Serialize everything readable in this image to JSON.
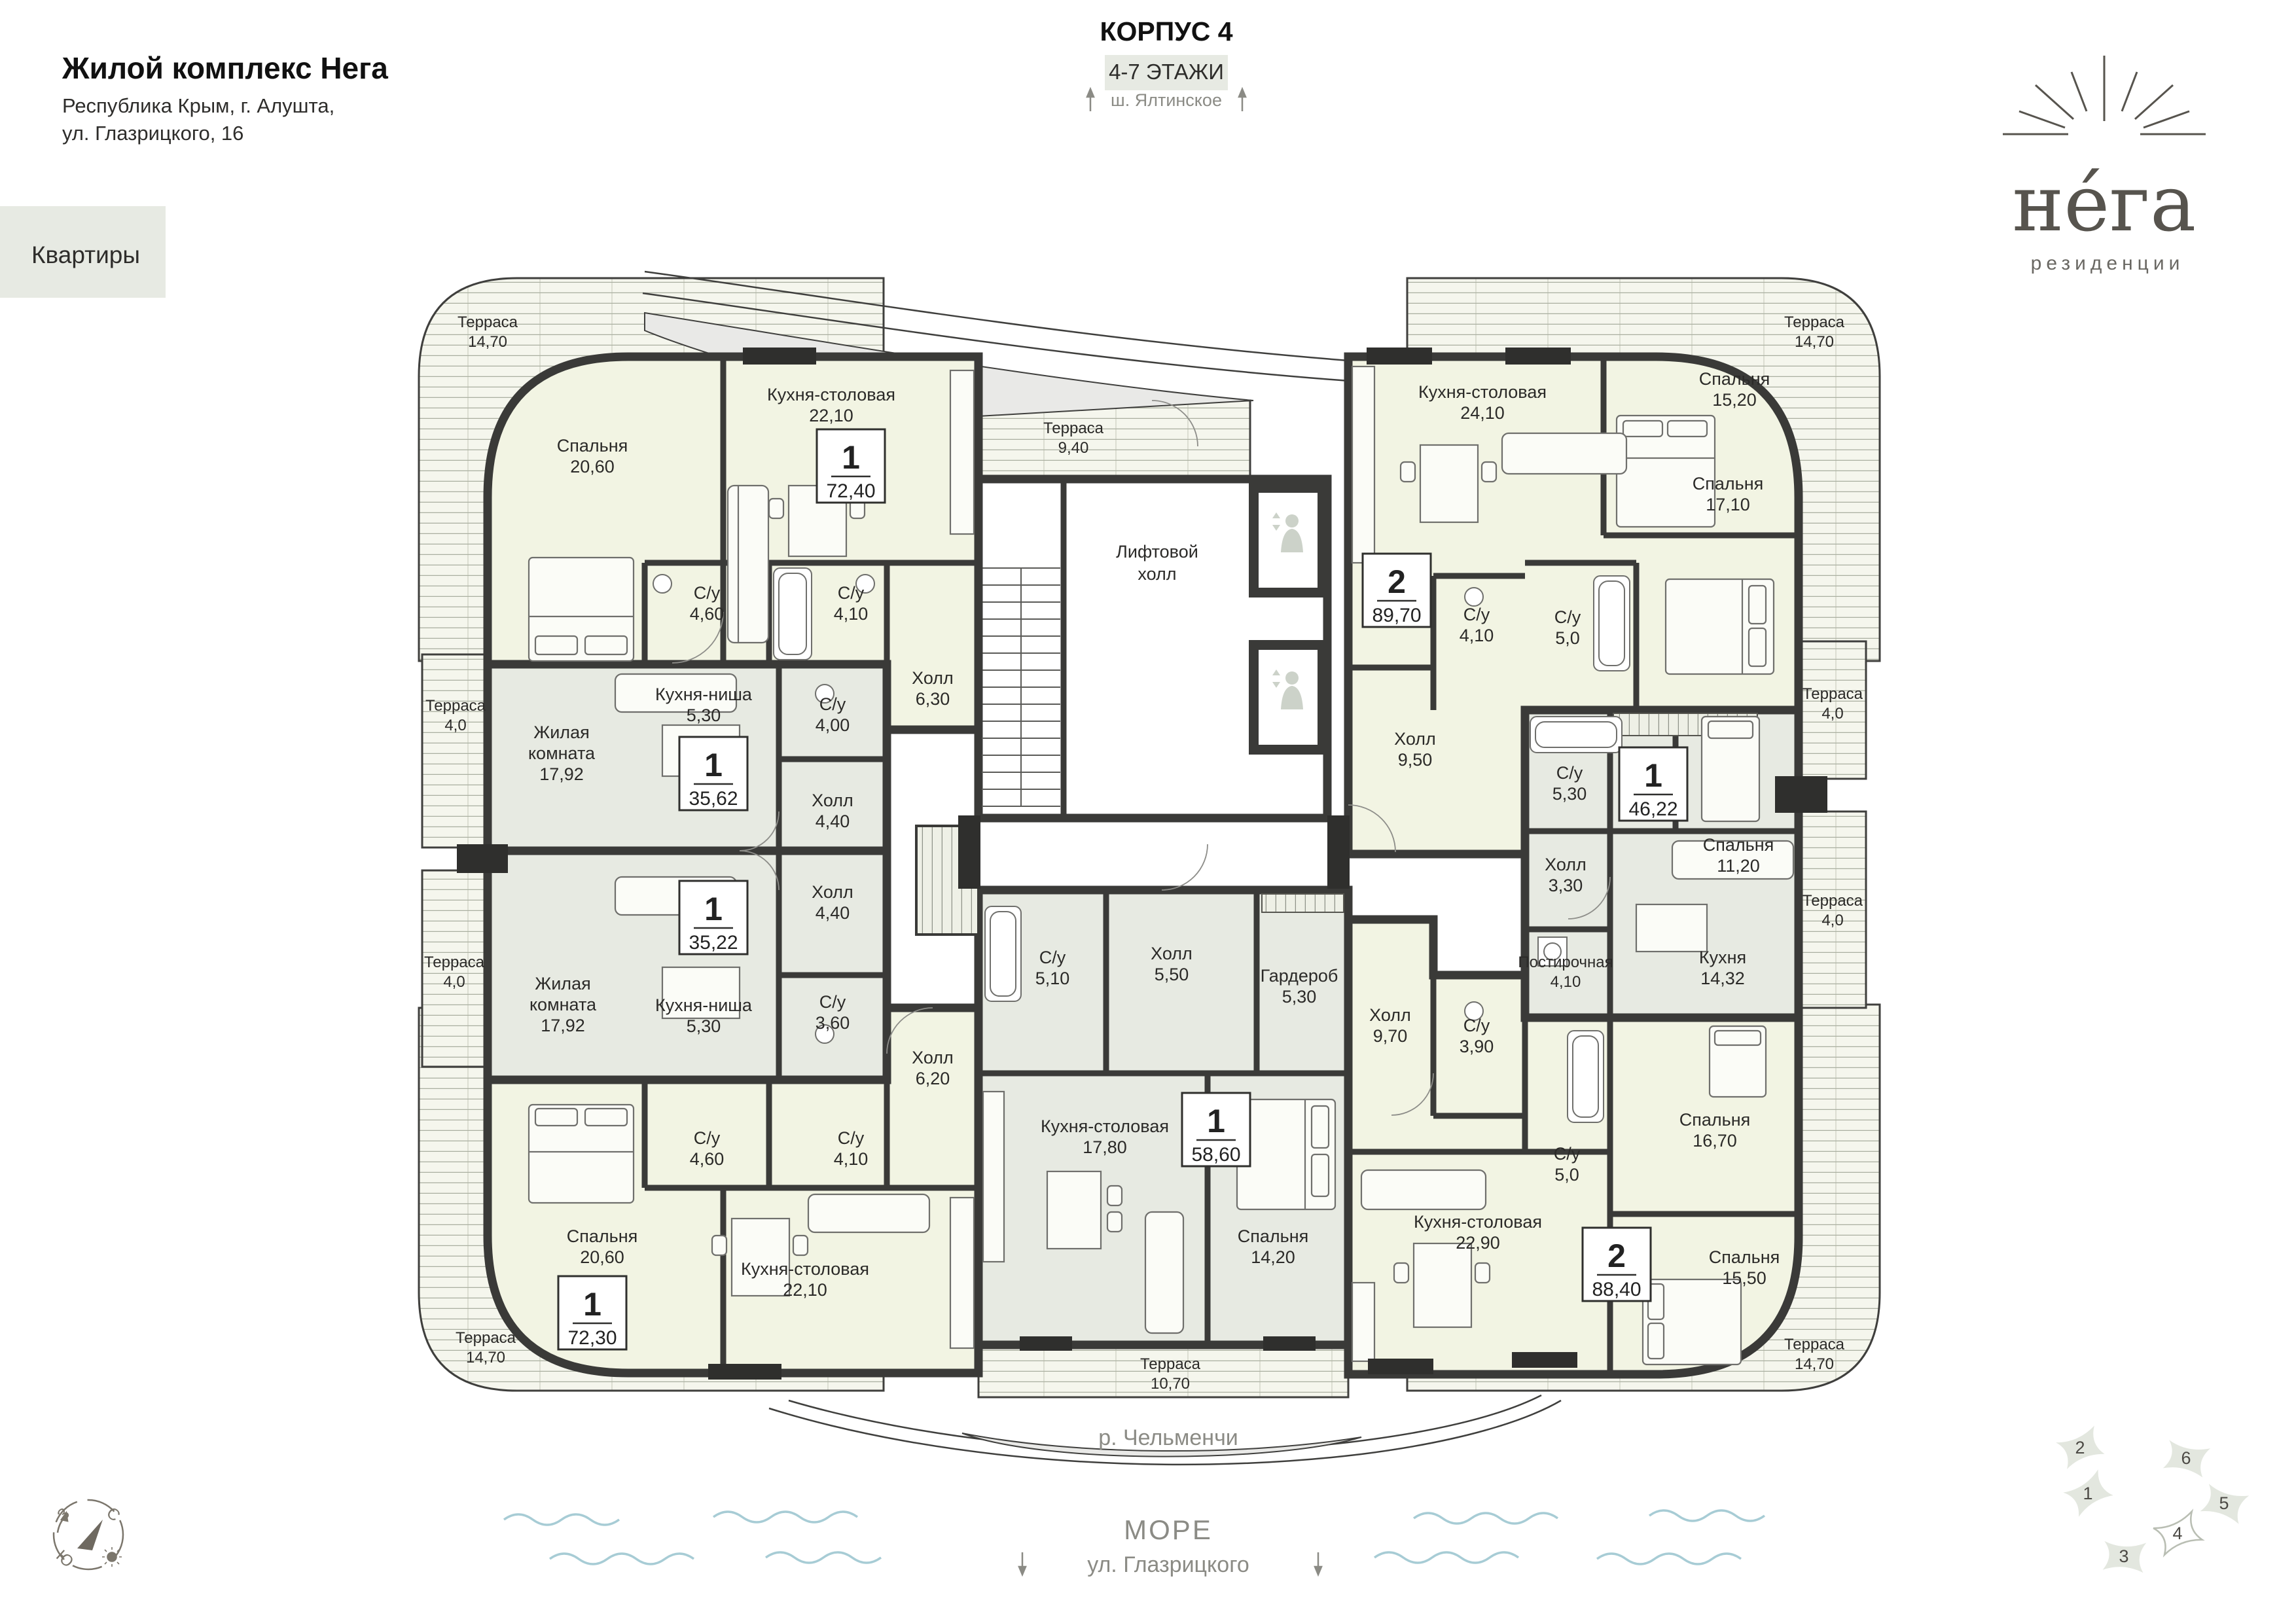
{
  "header": {
    "title": "Жилой комплекс Нега",
    "address_line1": "Республика Крым, г. Алушта,",
    "address_line2": "ул. Глазрицкого, 16",
    "nav_button": "Квартиры",
    "building": "КОРПУС 4",
    "floors": "4-7 ЭТАЖИ",
    "direction_top": "ш. Ялтинское"
  },
  "logo": {
    "name": "нéга",
    "subtitle": "резиденции"
  },
  "footer": {
    "river": "р. Чельменчи",
    "sea": "МОРЕ",
    "street": "ул. Глазрицкого"
  },
  "compass": {
    "west": "З",
    "north": "С",
    "south": "Ю"
  },
  "minimap": {
    "buildings": [
      "1",
      "2",
      "3",
      "4",
      "5",
      "6"
    ],
    "current": "4"
  },
  "plan": {
    "lift_hall_line1": "Лифтовой",
    "lift_hall_line2": "холл",
    "badges": [
      {
        "rooms": "1",
        "area": "72,40"
      },
      {
        "rooms": "1",
        "area": "35,62"
      },
      {
        "rooms": "1",
        "area": "35,22"
      },
      {
        "rooms": "1",
        "area": "72,30"
      },
      {
        "rooms": "1",
        "area": "58,60"
      },
      {
        "rooms": "2",
        "area": "89,70"
      },
      {
        "rooms": "1",
        "area": "46,22"
      },
      {
        "rooms": "2",
        "area": "88,40"
      }
    ],
    "terraces": [
      {
        "n": "Терраса",
        "a": "14,70"
      },
      {
        "n": "Терраса",
        "a": "14,70"
      },
      {
        "n": "Терраса",
        "a": "14,70"
      },
      {
        "n": "Терраса",
        "a": "14,70"
      },
      {
        "n": "Терраса",
        "a": "9,40"
      },
      {
        "n": "Терраса",
        "a": "10,70"
      },
      {
        "n": "Терраса",
        "a": "4,0"
      },
      {
        "n": "Терраса",
        "a": "4,0"
      },
      {
        "n": "Терраса",
        "a": "4,0"
      },
      {
        "n": "Терраса",
        "a": "4,0"
      }
    ],
    "rooms": [
      {
        "n": "Спальня",
        "a": "20,60"
      },
      {
        "n": "Кухня-столовая",
        "a": "22,10"
      },
      {
        "n": "С/у",
        "a": "4,60"
      },
      {
        "n": "С/у",
        "a": "4,10"
      },
      {
        "n": "Холл",
        "a": "6,30"
      },
      {
        "n": "Кухня-ниша",
        "a": "5,30"
      },
      {
        "l1": "Жилая",
        "l2": "комната",
        "a": "17,92"
      },
      {
        "n": "С/у",
        "a": "4,00"
      },
      {
        "n": "Холл",
        "a": "4,40"
      },
      {
        "n": "Холл",
        "a": "4,40"
      },
      {
        "n": "С/у",
        "a": "3,60"
      },
      {
        "n": "Кухня-ниша",
        "a": "5,30"
      },
      {
        "l1": "Жилая",
        "l2": "комната",
        "a": "17,92"
      },
      {
        "n": "С/у",
        "a": "4,60"
      },
      {
        "n": "С/у",
        "a": "4,10"
      },
      {
        "n": "Холл",
        "a": "6,20"
      },
      {
        "n": "Спальня",
        "a": "20,60"
      },
      {
        "n": "Кухня-столовая",
        "a": "22,10"
      },
      {
        "n": "С/у",
        "a": "5,10"
      },
      {
        "n": "Холл",
        "a": "5,50"
      },
      {
        "n": "Гардероб",
        "a": "5,30"
      },
      {
        "n": "Кухня-столовая",
        "a": "17,80"
      },
      {
        "n": "Спальня",
        "a": "14,20"
      },
      {
        "n": "Кухня-столовая",
        "a": "24,10"
      },
      {
        "n": "Спальня",
        "a": "15,20"
      },
      {
        "n": "Спальня",
        "a": "17,10"
      },
      {
        "n": "С/у",
        "a": "4,10"
      },
      {
        "n": "С/у",
        "a": "5,0"
      },
      {
        "n": "Холл",
        "a": "9,50"
      },
      {
        "n": "С/у",
        "a": "5,30"
      },
      {
        "n": "Спальня",
        "a": "11,20"
      },
      {
        "n": "Холл",
        "a": "3,30"
      },
      {
        "n": "Кухня",
        "a": "14,32"
      },
      {
        "n": "Постирочная",
        "a": "4,10"
      },
      {
        "n": "Холл",
        "a": "9,70"
      },
      {
        "n": "С/у",
        "a": "3,90"
      },
      {
        "n": "С/у",
        "a": "5,0"
      },
      {
        "n": "Кухня-столовая",
        "a": "22,90"
      },
      {
        "n": "Спальня",
        "a": "16,70"
      },
      {
        "n": "Спальня",
        "a": "15,50"
      }
    ]
  },
  "palette": {
    "wall": "#3a3a38",
    "unit_cream": "#f2f4e3",
    "unit_gray": "#e7eae2",
    "terrace_bg": "#f5f6ed",
    "terrace_line": "#a9ae9f",
    "accent_block": "#e7eae3",
    "muted_text": "#8b8b85",
    "wave": "#a7ccd5",
    "logo": "#57544e"
  }
}
